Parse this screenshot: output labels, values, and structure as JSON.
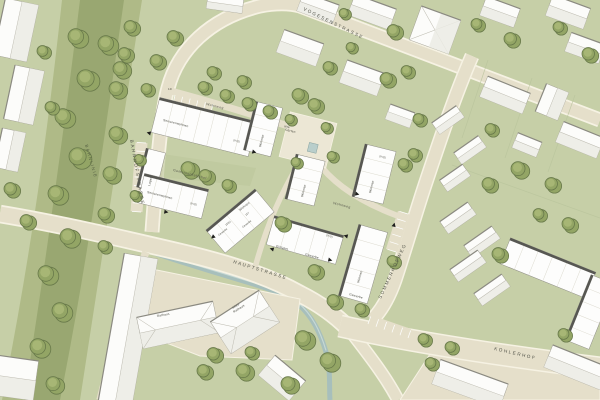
{
  "map": {
    "streets": {
      "bahnlinie": "BAHNLINIE",
      "bahnhofstrasse": "BAHNHOFSTRASSE",
      "vogesenstrasse": "VOGESENSTRASSE",
      "hauptstrasse": "HAUPTSTRASSE",
      "sommerhofweg": "SOMMERHOFWEG",
      "kohlerhof": "KOHLERHOF",
      "wohnweg": "Wohnweg"
    },
    "places": {
      "gemeinschaftshof": "Gemeinschaftshof",
      "alte_gaerten_line1": "alte",
      "alte_gaerten_line2": "Gärten",
      "haus_nr": "10"
    },
    "buildings": {
      "seniorenwohnen": "Seniorenwohnen",
      "wohnen": "Wohnen",
      "gewerbe": "Gewerbe",
      "lager": "Lager",
      "einfahrt": "Einfahrt",
      "rathaus": "Rathaus",
      "altes_rathaus_line1": "Altes",
      "altes_rathaus_line2": "Rathaus",
      "floors": "(II+D)",
      "parcel_1": "156/1",
      "parcel_2": "157"
    },
    "colors": {
      "green": "#c6cfa7",
      "road": "#e5dfca",
      "roadEdge": "#f6f2e3",
      "plaza": "#ece7d5",
      "rail1": "#afba87",
      "rail2": "#99a771",
      "tree": "#93a565",
      "treeDark": "#68794a",
      "treeLight": "#aab877",
      "water": "#a7bfbc",
      "slabShadow": "#57575​2",
      "text": "#4b4c41",
      "parcelLine": "#b9c49c"
    }
  }
}
